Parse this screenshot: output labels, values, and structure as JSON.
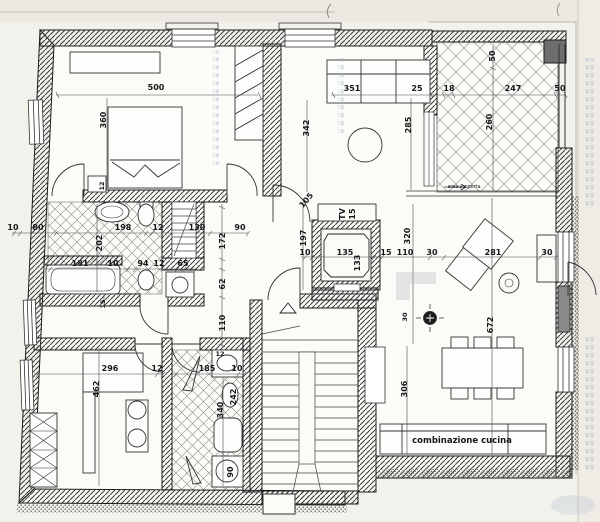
{
  "colors": {
    "paper": "#f2f1eb",
    "ink": "#1b1b1b",
    "wallhatch": "#3a3a3a",
    "bleed": "#93a9c8"
  },
  "labels": {
    "terrace": "area scoperta",
    "kitchen": "combinazione cucina",
    "tv": "TV",
    "tv_depth": "15"
  },
  "dims": {
    "bedroom": {
      "width": "500",
      "depth": "360",
      "wall12": "12"
    },
    "living_top_chain": [
      "351",
      "25",
      "18",
      "247",
      "50"
    ],
    "terrace": {
      "top50": "50",
      "side260": "260",
      "left285": "285",
      "wall342": "342"
    },
    "bath1": {
      "chain_a": [
        "10",
        "80",
        "198",
        "12",
        "130",
        "90"
      ],
      "chain_b": [
        "181",
        "10",
        "94",
        "12",
        "65"
      ],
      "v202": "202",
      "v172": "172",
      "v62": "62",
      "v110": "110",
      "v15": "15"
    },
    "center": {
      "chain": [
        "10",
        "135",
        "15",
        "110",
        "30",
        "281",
        "30"
      ],
      "v133": "133",
      "door105": "105",
      "v197": "197",
      "v320": "320",
      "v30": "30",
      "v672": "672",
      "v306": "306"
    },
    "studio": {
      "chain": [
        "296",
        "12"
      ],
      "v462": "462"
    },
    "bath2": {
      "chain": [
        "185",
        "10"
      ],
      "top12": "12",
      "v242": "242",
      "v340": "340",
      "shower90": "90"
    }
  }
}
